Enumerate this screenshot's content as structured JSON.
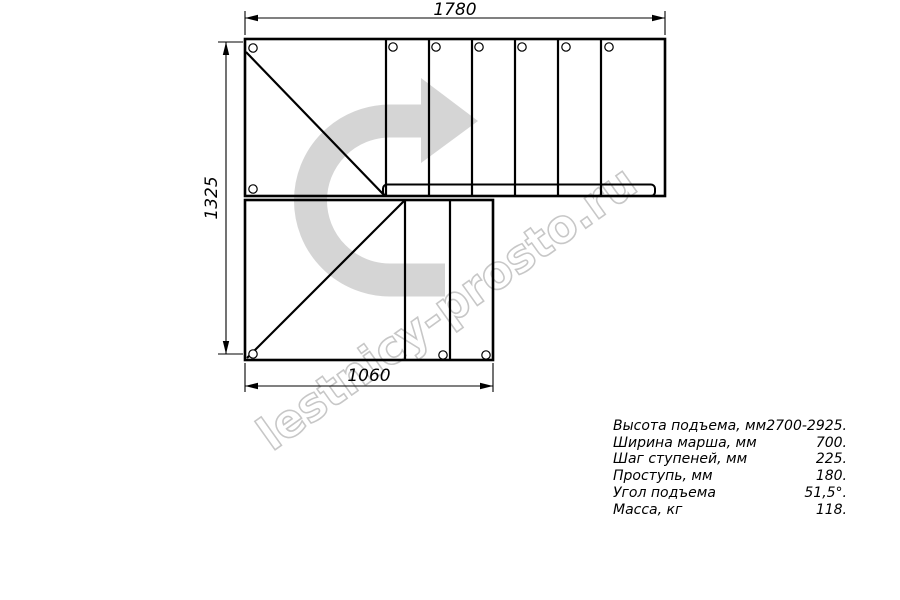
{
  "watermark": {
    "text": "lestnicy-prosto.ru",
    "color": "#c7c7c7"
  },
  "plan": {
    "dim_top": "1780",
    "dim_left": "1325",
    "dim_bottom": "1060",
    "arrow_color": "#d5d5d5",
    "line_color": "#000000",
    "background": "#ffffff"
  },
  "specs": {
    "rows": [
      {
        "label": "Высота подъема, мм",
        "value": "2700-2925."
      },
      {
        "label": "Ширина марша, мм",
        "value": "700."
      },
      {
        "label": "Шаг ступеней, мм",
        "value": "225."
      },
      {
        "label": "Проступь, мм",
        "value": "180."
      },
      {
        "label": "Угол подъема",
        "value": "51,5°."
      },
      {
        "label": "Масса, кг",
        "value": "118."
      }
    ]
  }
}
